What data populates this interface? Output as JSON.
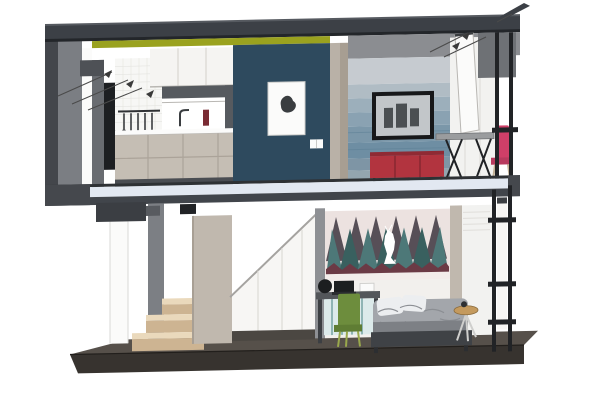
{
  "meta": {
    "title": "Sectional 3D rendering of a two-storey loft micro-apartment (SketchUp style cutaway)"
  },
  "scene": {
    "description": "Cutaway section perspective of a two-storey micro apartment",
    "upper_floor": [
      "kitchen: white upper cabinets, dark hood shelf, white tile backsplash with hanging utensil rail, beige base cabinets with counter and faucet",
      "navy accent wall with white framed abstract print and light switch",
      "living wall with layered blue water mural and wall-mounted TV",
      "red sideboard on legs",
      "grey trestle desk with X legs",
      "pink chair at window frame"
    ],
    "lower_floor": [
      "winder staircase with timber treads",
      "white under-stair closet with sloped top",
      "beige wardrobe panel",
      "bedroom forest mural with white deer silhouette",
      "desk with laptop and green chair",
      "bed with grey rumpled bedding and white pillows",
      "round brass-top side stool",
      "black exterior access ladder"
    ],
    "structure": [
      "dark roof slab with right overhang",
      "yellow-green ceiling light strip",
      "layered grey party wall on the left",
      "intermediate floor slab, pale blue with dark edges",
      "dark plinth base slab in perspective",
      "loose pencil sketch marks near roof corners"
    ]
  },
  "palette": {
    "white": "#ffffff",
    "roof": "#3c4046",
    "roof_top": "#565a60",
    "roof_dark": "#23262a",
    "accent_yellow": "#9aa21f",
    "wall_dark": "#43464b",
    "wall_grey": "#7b7e83",
    "wall_mid": "#696c71",
    "wall_step": "#4e5156",
    "black_panel": "#1d1f22",
    "tile_white": "#f7f7f5",
    "tile_line": "#e4e4e0",
    "utensil": "#2f3134",
    "cabinet_white": "#f5f4f2",
    "cabinet_seam": "#d8d6d2",
    "cabinet_edge": "#b9b7b3",
    "hood": "#565a5f",
    "bottle": "#7a2b33",
    "cabinet_beige": "#c5beb4",
    "beige_seam": "#aba399",
    "kick": "#4a4d52",
    "navy": "#2e4a5e",
    "frame_white": "#fbfbfa",
    "art_dark": "#3a3d40",
    "divider_light": "#b9b1a7",
    "divider_dark": "#a79e92",
    "fascia_grey": "#8b8d91",
    "soffit_grey": "#6e7175",
    "mural_stripes": [
      "#c6cbd0",
      "#b0bcc4",
      "#9cafbb",
      "#8aa2b2",
      "#7b97a9",
      "#6e8ea3",
      "#7e95a5",
      "#93a5af"
    ],
    "mural_streak": "#5d7f95",
    "tv": "#17181a",
    "tv_screen": "#c2c6c9",
    "tv_speckle": "#4b4f52",
    "red_cabinet": "#b2343f",
    "red_dark": "#8f2a34",
    "red_seam": "#7e252e",
    "desk_grey": "#9a9c9e",
    "leg_black": "#202225",
    "pink": "#cf3f68",
    "pink_dark": "#b83a5e",
    "wood_leg": "#c2b196",
    "slab_edge": "#2e3134",
    "slab_light": "#e2e8f1",
    "slab_dark": "#41454b",
    "slab_cap": "#45484d",
    "bracket": "#3b3e43",
    "bracket_light": "#585b60",
    "column_grey": "#7c7f84",
    "panel_edge": "#d9d9d7",
    "wardrobe": "#c0b8ae",
    "wardrobe_edge": "#a89f94",
    "closet_white": "#f7f6f4",
    "closet_line": "#a5a3a0",
    "seam_light": "#dddbd7",
    "plinth": "#4b4742",
    "step_top": "#ead9bc",
    "step_front": "#cdb492",
    "strip_grey": "#8e9094",
    "mural2_bg": "#ece2e0",
    "tree_plum": "#574f57",
    "tree_teal": "#4d7878",
    "tree_teal_dark": "#39605f",
    "maroon": "#6b3a45",
    "mural2_band": "#f3ecea",
    "wall_white": "#f2f0ed",
    "panel_white": "#f2f2f0",
    "panel_line": "#dcdad6",
    "desk_top": "#53565a",
    "desk_leg": "#3c3f43",
    "laptop": "#1c1e20",
    "laptop_base": "#2a2c2f",
    "underdesk": "#dceaea",
    "underdesk_line": "#8fb4b4",
    "chair_green": "#6d8d3d",
    "chair_green_dark": "#5f7d34",
    "chair_leg": "#9aa94c",
    "bedding": "#a3a6ab",
    "bedding_dark": "#7d8085",
    "pillow": "#eceef0",
    "rumple": "#8b8e93",
    "bed_frame": "#3f4246",
    "bed_leg": "#2c2e31",
    "stool_top": "#c49a5e",
    "stool_leg": "#cfcfcd",
    "stool_item": "#2e3033",
    "ladder": "#212326",
    "base_top": "#56504a",
    "base_front": "#37332f",
    "base_line": "#221f1c",
    "sketch": "#4a4a4a",
    "sketch_fill": "#3a3a3a"
  }
}
